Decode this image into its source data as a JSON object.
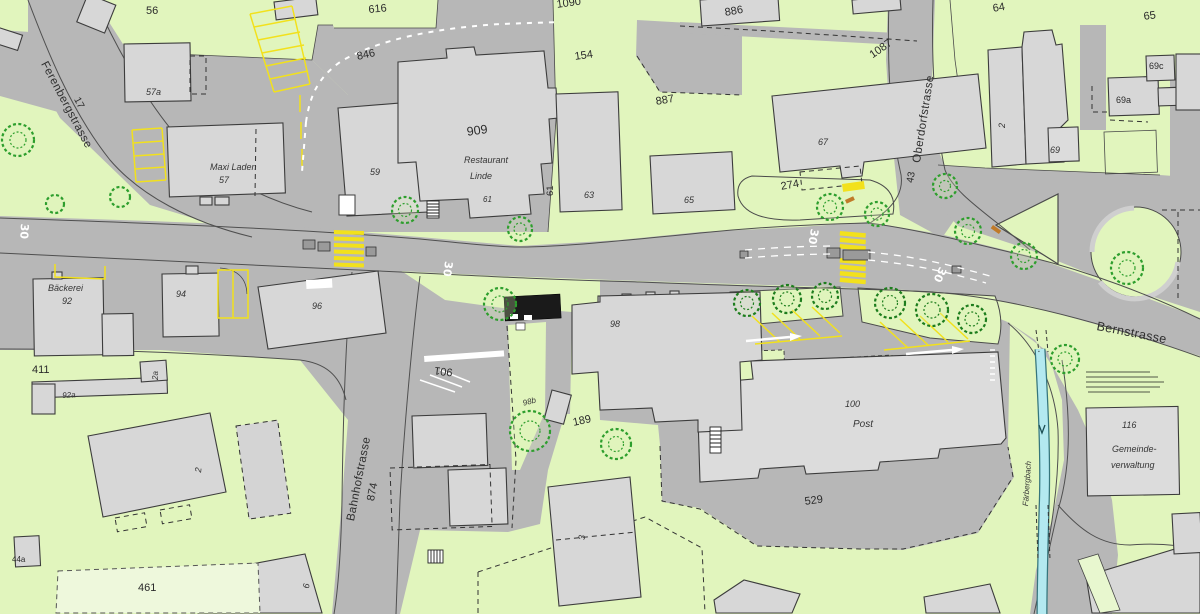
{
  "map": {
    "kind": "cadastral-town-plan",
    "streets": [
      "Ferenbergstrasse",
      "Oberdorfstrasse",
      "Bernstrasse",
      "Bahnhofstrasse"
    ],
    "waterways": [
      "Färbergbach"
    ],
    "pois": [
      {
        "name": "Maxi Laden",
        "number": "57"
      },
      {
        "name": "Restaurant Linde",
        "number": "909 / 61"
      },
      {
        "name": "Bäckerei",
        "number": "92"
      },
      {
        "name": "Post",
        "number": "100"
      },
      {
        "name": "Gemeindeverwaltung",
        "number": "116"
      }
    ],
    "parcel_numbers": [
      "56",
      "616",
      "1090",
      "154",
      "886",
      "887",
      "1087",
      "64",
      "65",
      "846",
      "274",
      "411",
      "461",
      "189",
      "529",
      "17",
      "43"
    ],
    "building_numbers": [
      "57a",
      "57",
      "59",
      "61",
      "63",
      "65",
      "67",
      "2",
      "69",
      "69a",
      "69c",
      "92",
      "92a",
      "2a",
      "94",
      "96",
      "98",
      "98b",
      "100",
      "3",
      "6",
      "44a",
      "116",
      "874",
      "901"
    ],
    "road_markings": [
      "30",
      "30",
      "30",
      "30"
    ],
    "colors": {
      "background_green": "#e1f5bd",
      "paved": "#b7b7b7",
      "building": "#d7d7d7",
      "outline": "#3c3c3c",
      "tree_green": "#2d9e2d",
      "marking_yellow": "#f2e11c",
      "marking_white": "#ffffff",
      "stream_blue": "#b3e9f0",
      "accent_orange": "#c07a28",
      "black_shelter": "#1a1a1a"
    }
  },
  "labels": [
    {
      "text": "56"
    },
    {
      "text": "616"
    },
    {
      "text": "1090"
    },
    {
      "text": "154"
    },
    {
      "text": "886"
    },
    {
      "text": "887"
    },
    {
      "text": "1087"
    },
    {
      "text": "64"
    },
    {
      "text": "65"
    },
    {
      "text": "Ferenbergstrasse"
    },
    {
      "text": "17"
    },
    {
      "text": "846"
    },
    {
      "text": "909"
    },
    {
      "text": "Restaurant"
    },
    {
      "text": "Linde"
    },
    {
      "text": "59"
    },
    {
      "text": "61"
    },
    {
      "text": "61"
    },
    {
      "text": "63"
    },
    {
      "text": "65"
    },
    {
      "text": "67"
    },
    {
      "text": "274"
    },
    {
      "text": "Oberdorfstrasse"
    },
    {
      "text": "43"
    },
    {
      "text": "2"
    },
    {
      "text": "69"
    },
    {
      "text": "69a"
    },
    {
      "text": "69c"
    },
    {
      "text": "Bäckerei"
    },
    {
      "text": "92"
    },
    {
      "text": "94"
    },
    {
      "text": "96"
    },
    {
      "text": "411"
    },
    {
      "text": "92a"
    },
    {
      "text": "2a"
    },
    {
      "text": "901"
    },
    {
      "text": "98"
    },
    {
      "text": "98b"
    },
    {
      "text": "189"
    },
    {
      "text": "Bahnhofstrasse"
    },
    {
      "text": "874"
    },
    {
      "text": "3"
    },
    {
      "text": "100"
    },
    {
      "text": "Post"
    },
    {
      "text": "529"
    },
    {
      "text": "Bernstrasse"
    },
    {
      "text": "116"
    },
    {
      "text": "Gemeinde-"
    },
    {
      "text": "verwaltung"
    },
    {
      "text": "Färbergbach"
    },
    {
      "text": "461"
    },
    {
      "text": "2"
    },
    {
      "text": "44a"
    },
    {
      "text": "6"
    },
    {
      "text": "30"
    },
    {
      "text": "30"
    },
    {
      "text": "30"
    },
    {
      "text": "30"
    },
    {
      "text": "57a"
    },
    {
      "text": "Maxi Laden"
    },
    {
      "text": "57"
    }
  ]
}
